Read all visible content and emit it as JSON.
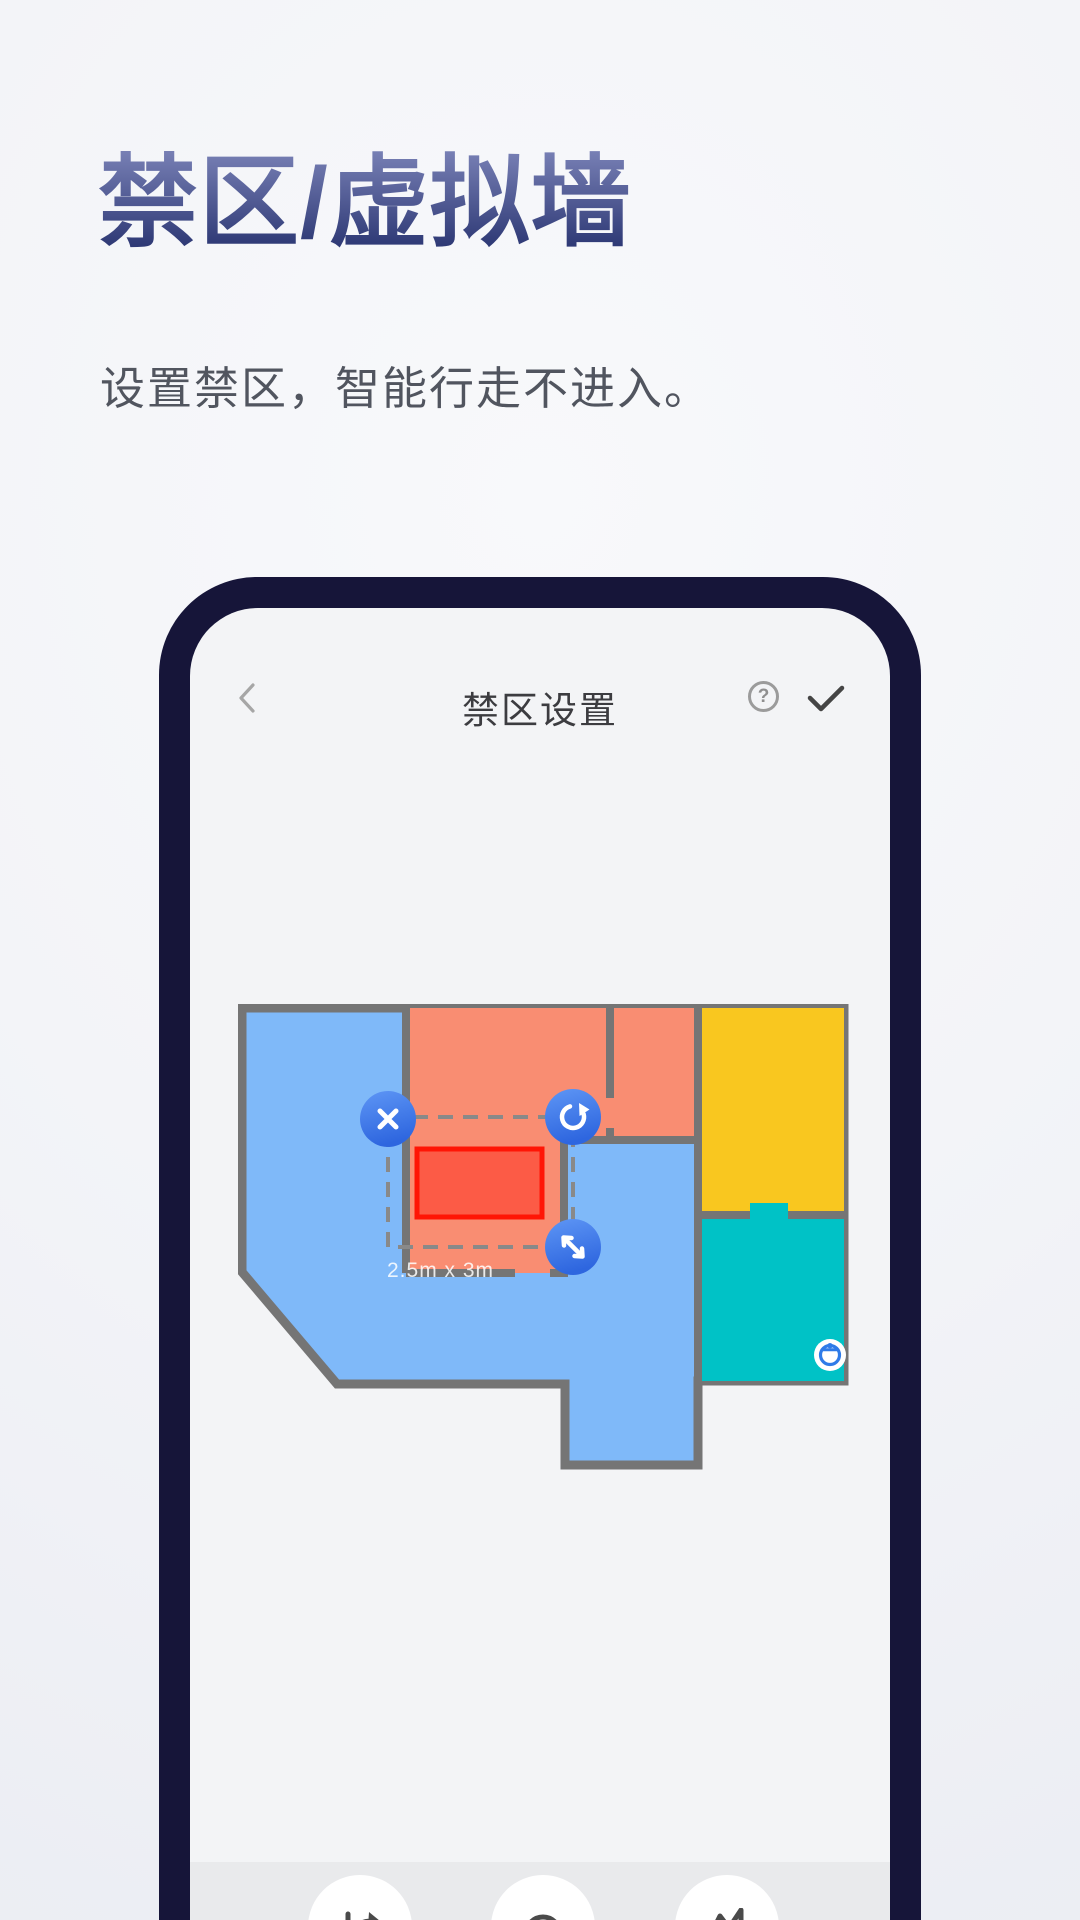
{
  "hero": {
    "title": "禁区/虚拟墙",
    "subtitle": "设置禁区，智能行走不进入。"
  },
  "phone": {
    "header": {
      "back_icon": "chevron-left",
      "title": "禁区设置",
      "help_glyph": "?",
      "confirm_icon": "checkmark"
    },
    "map": {
      "zone_label": "2.5m x 3m",
      "rooms": [
        {
          "name": "left-room",
          "color": "#7FB9F9"
        },
        {
          "name": "middle-room",
          "color": "#F98D72"
        },
        {
          "name": "upper-right-room",
          "color": "#F98D72"
        },
        {
          "name": "yellow-room",
          "color": "#F9C71F"
        },
        {
          "name": "teal-room",
          "color": "#00C2C6"
        }
      ],
      "no_go_zone": {
        "fill": "#FF2A1A",
        "border": "#FF1505",
        "handles": [
          {
            "icon": "delete-x-icon"
          },
          {
            "icon": "rotate-icon"
          },
          {
            "icon": "resize-diagonal-icon"
          }
        ]
      },
      "robot": {
        "icon": "robot-vacuum-icon",
        "accent": "#2F7BE8"
      }
    },
    "toolbar": {
      "buttons": [
        {
          "icon": "split-arrow-icon"
        },
        {
          "icon": "zone-circle-icon"
        },
        {
          "icon": "zigzag-wall-icon"
        }
      ]
    }
  },
  "colors": {
    "frame": "#161539",
    "screen-bg": "#F3F4F6",
    "toolbar-bg": "#E9EAEC",
    "title-grad-top": "#7A82B7",
    "title-grad-bottom": "#2F3A76",
    "room-blue": "#7FB9F9",
    "room-salmon": "#F98D72",
    "room-yellow": "#F9C71F",
    "room-teal": "#00C2C6",
    "wall": "#757575",
    "handle-grad-top": "#5E96F5",
    "handle-grad-bottom": "#2E66DF"
  }
}
